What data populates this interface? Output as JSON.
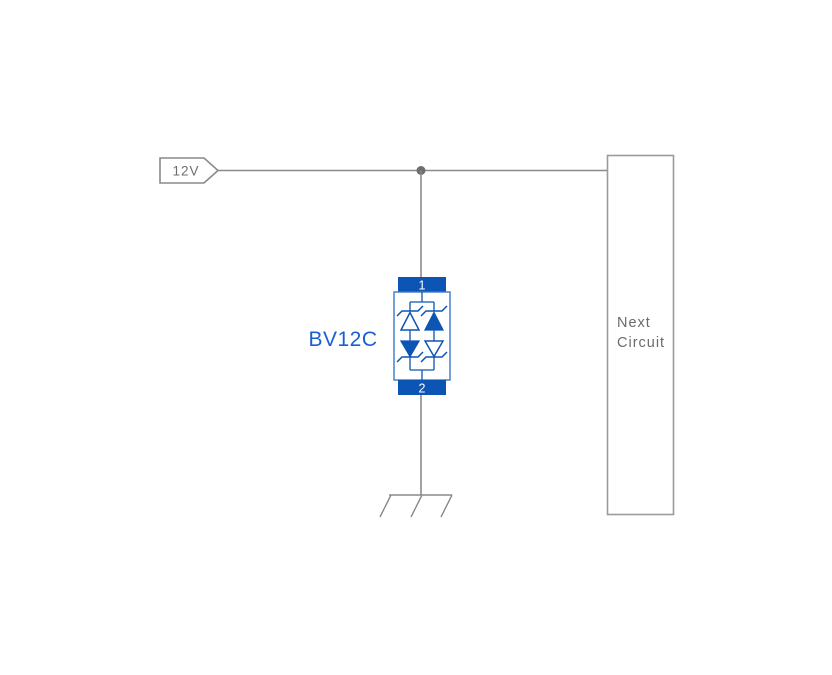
{
  "diagram": {
    "power_flag": {
      "label": "12V"
    },
    "tvs_component": {
      "label": "BV12C",
      "pin_top_label": "1",
      "pin_bottom_label": "2"
    },
    "next_circuit_box": {
      "line1": "Next",
      "line2": "Circuit"
    },
    "ground_symbol": "chassis-ground-icon",
    "colors": {
      "component_blue": "#0d55b4",
      "component_outline_blue": "#3c79c8",
      "label_blue": "#1a5fd2",
      "wire_gray": "#8a8a8a",
      "text_gray": "#6b6b6b"
    }
  }
}
